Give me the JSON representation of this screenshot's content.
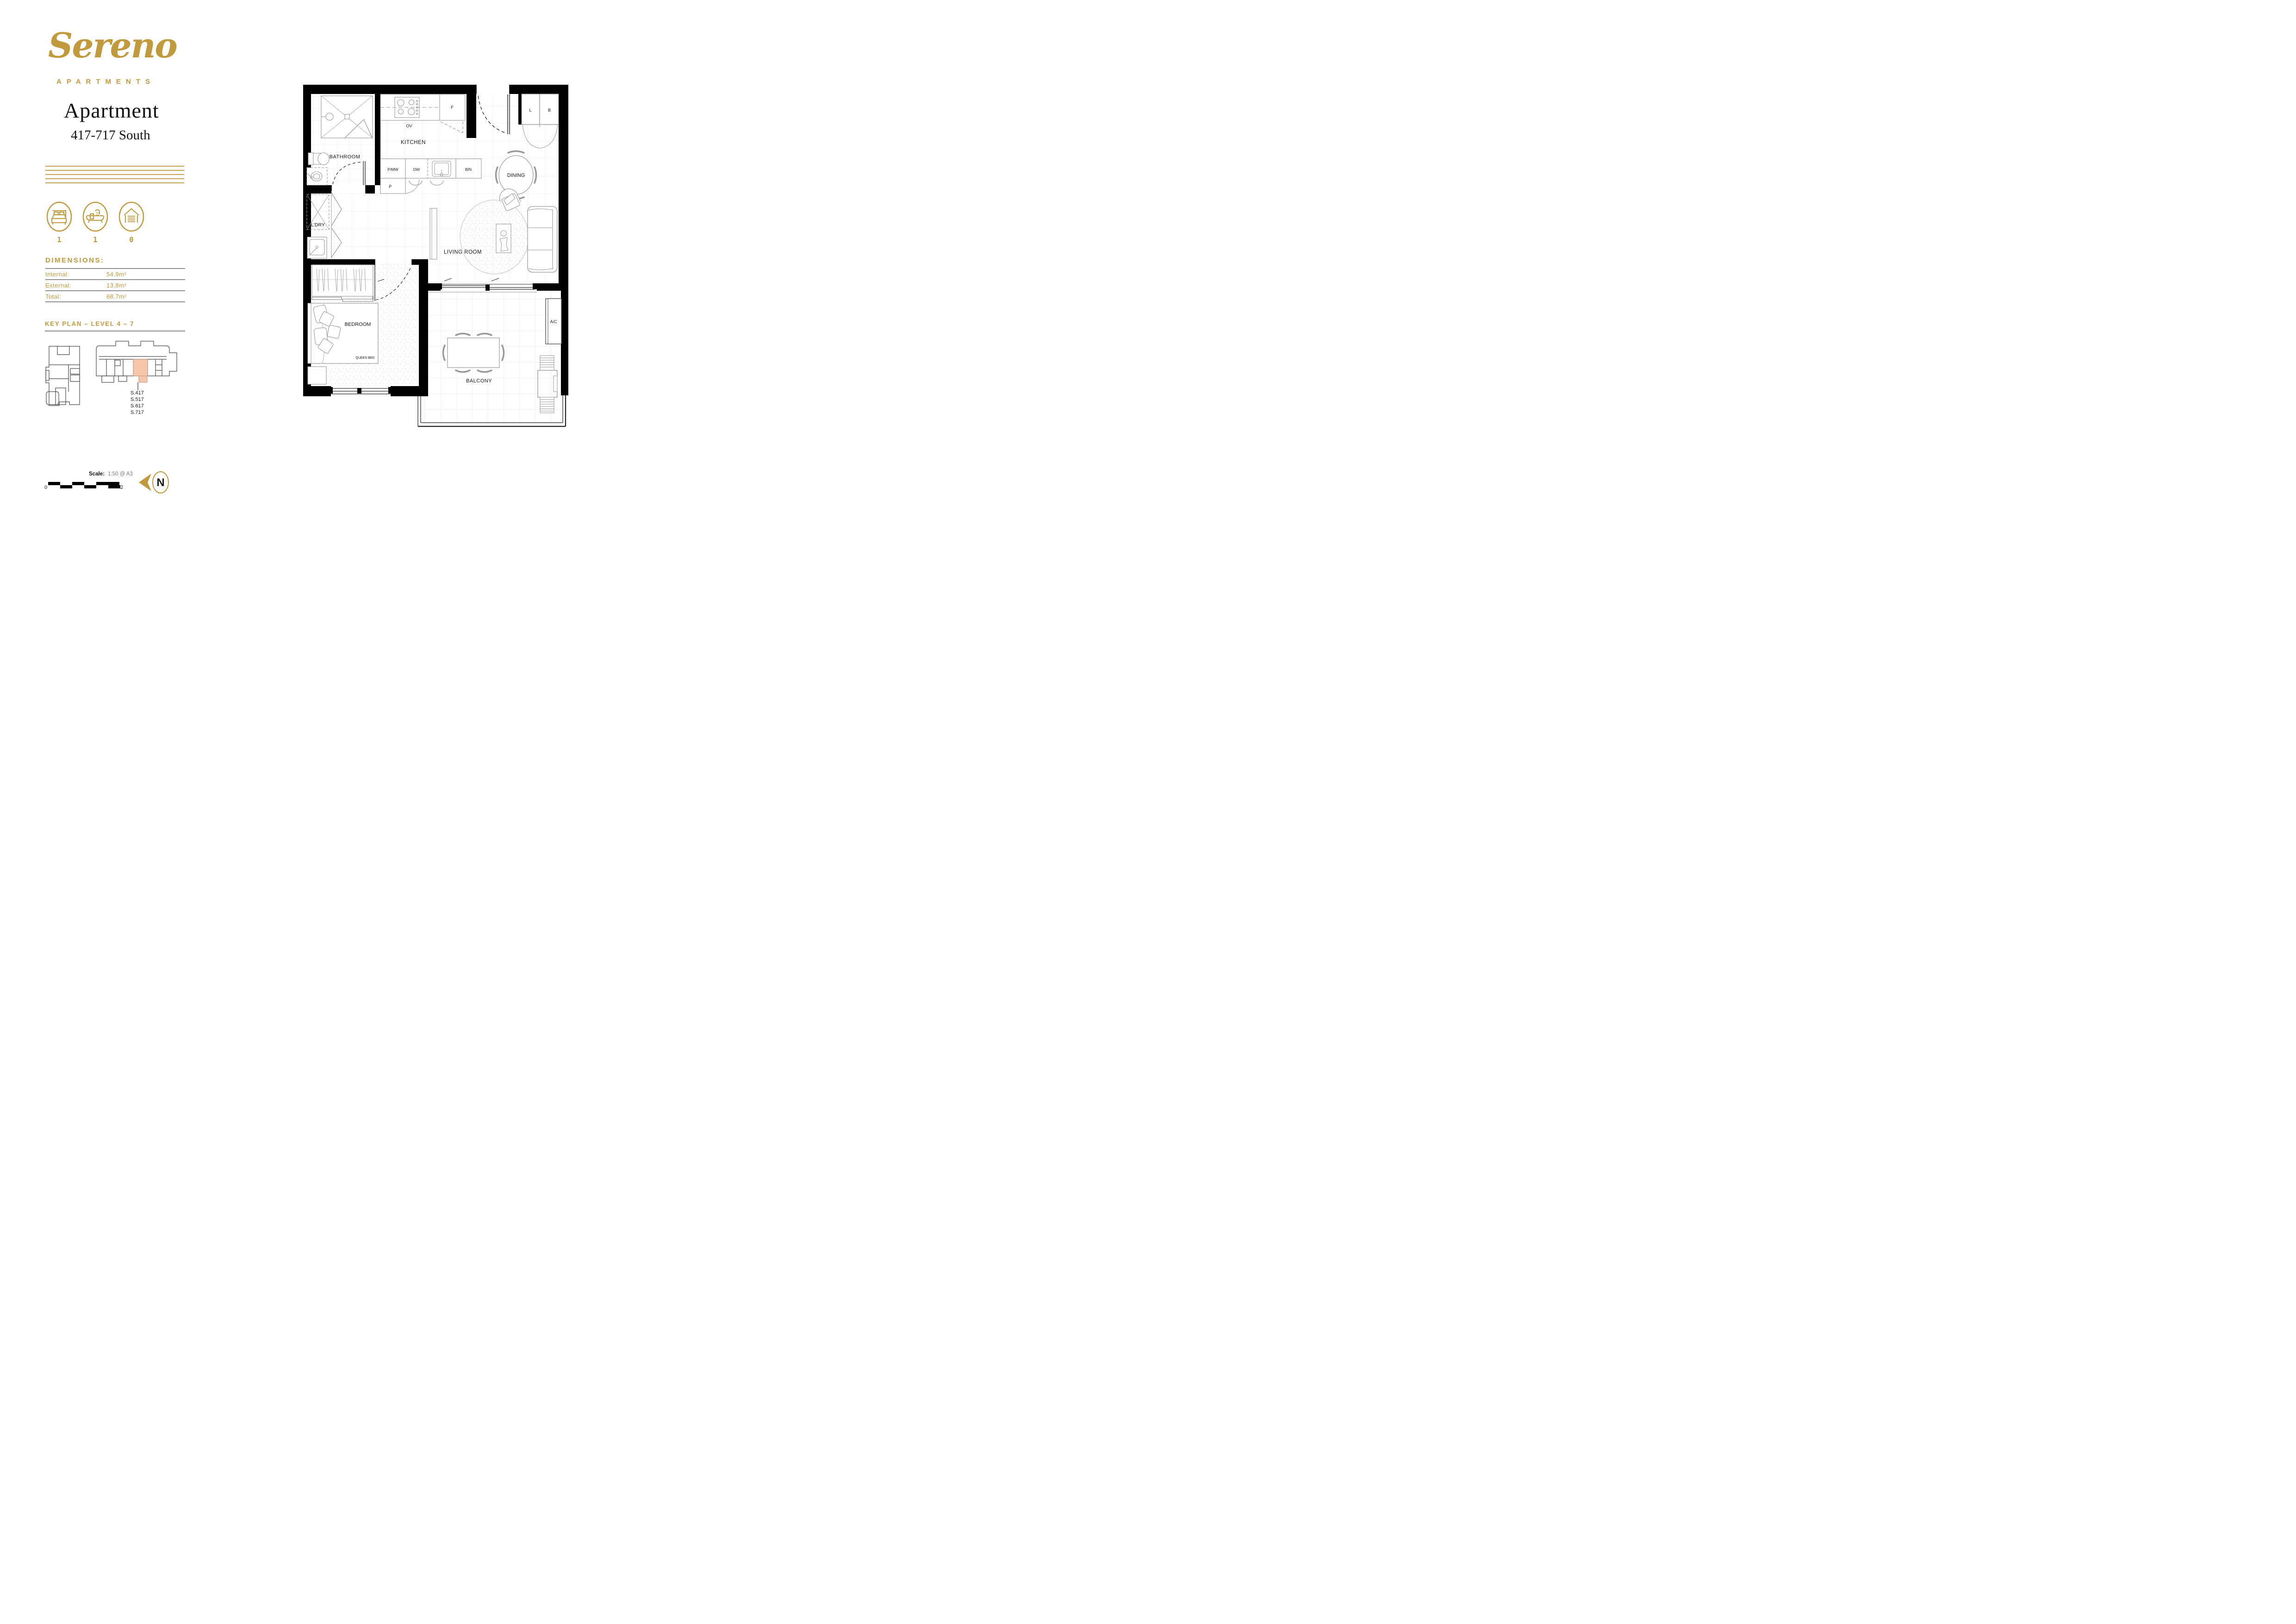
{
  "brand": {
    "logo_text": "Sereno",
    "logo_sub": "APARTMENTS"
  },
  "header": {
    "title": "Apartment",
    "subtitle": "417-717 South"
  },
  "summary": {
    "bedrooms": "1",
    "bathrooms": "1",
    "parking": "0"
  },
  "dimensions": {
    "heading": "DIMENSIONS:",
    "rows": [
      {
        "label": "Internal:",
        "value": "54.9m²"
      },
      {
        "label": "External:",
        "value": "13.8m²"
      },
      {
        "label": "Total:",
        "value": "68.7m²"
      }
    ]
  },
  "key_plan": {
    "heading": "KEY PLAN – LEVEL 4 – 7",
    "units": [
      "S.417",
      "S.517",
      "S.617",
      "S.717"
    ]
  },
  "plan": {
    "bathroom": "BATHROOM",
    "kitchen": "KITCHEN",
    "oven": "OV",
    "fridge": "F",
    "pantry_microwave": "P/MW",
    "dishwasher": "DW",
    "bin": "BIN",
    "pantry": "P",
    "linen": "L",
    "broom": "B",
    "dining": "DINING",
    "laundry": "L'DRY",
    "living": "LIVING ROOM",
    "bedroom": "BEDROOM",
    "queen_bed": "QUEEN BED",
    "ac": "A/C",
    "balcony": "BALCONY"
  },
  "footer": {
    "scale_label": "Scale:",
    "scale_value": "1:50  @ A3",
    "bar_min": "0",
    "bar_max": "2",
    "north": "N"
  },
  "colors": {
    "gold": "#C19A3E",
    "salmon": "#F5C5AC",
    "wall": "#000000"
  }
}
